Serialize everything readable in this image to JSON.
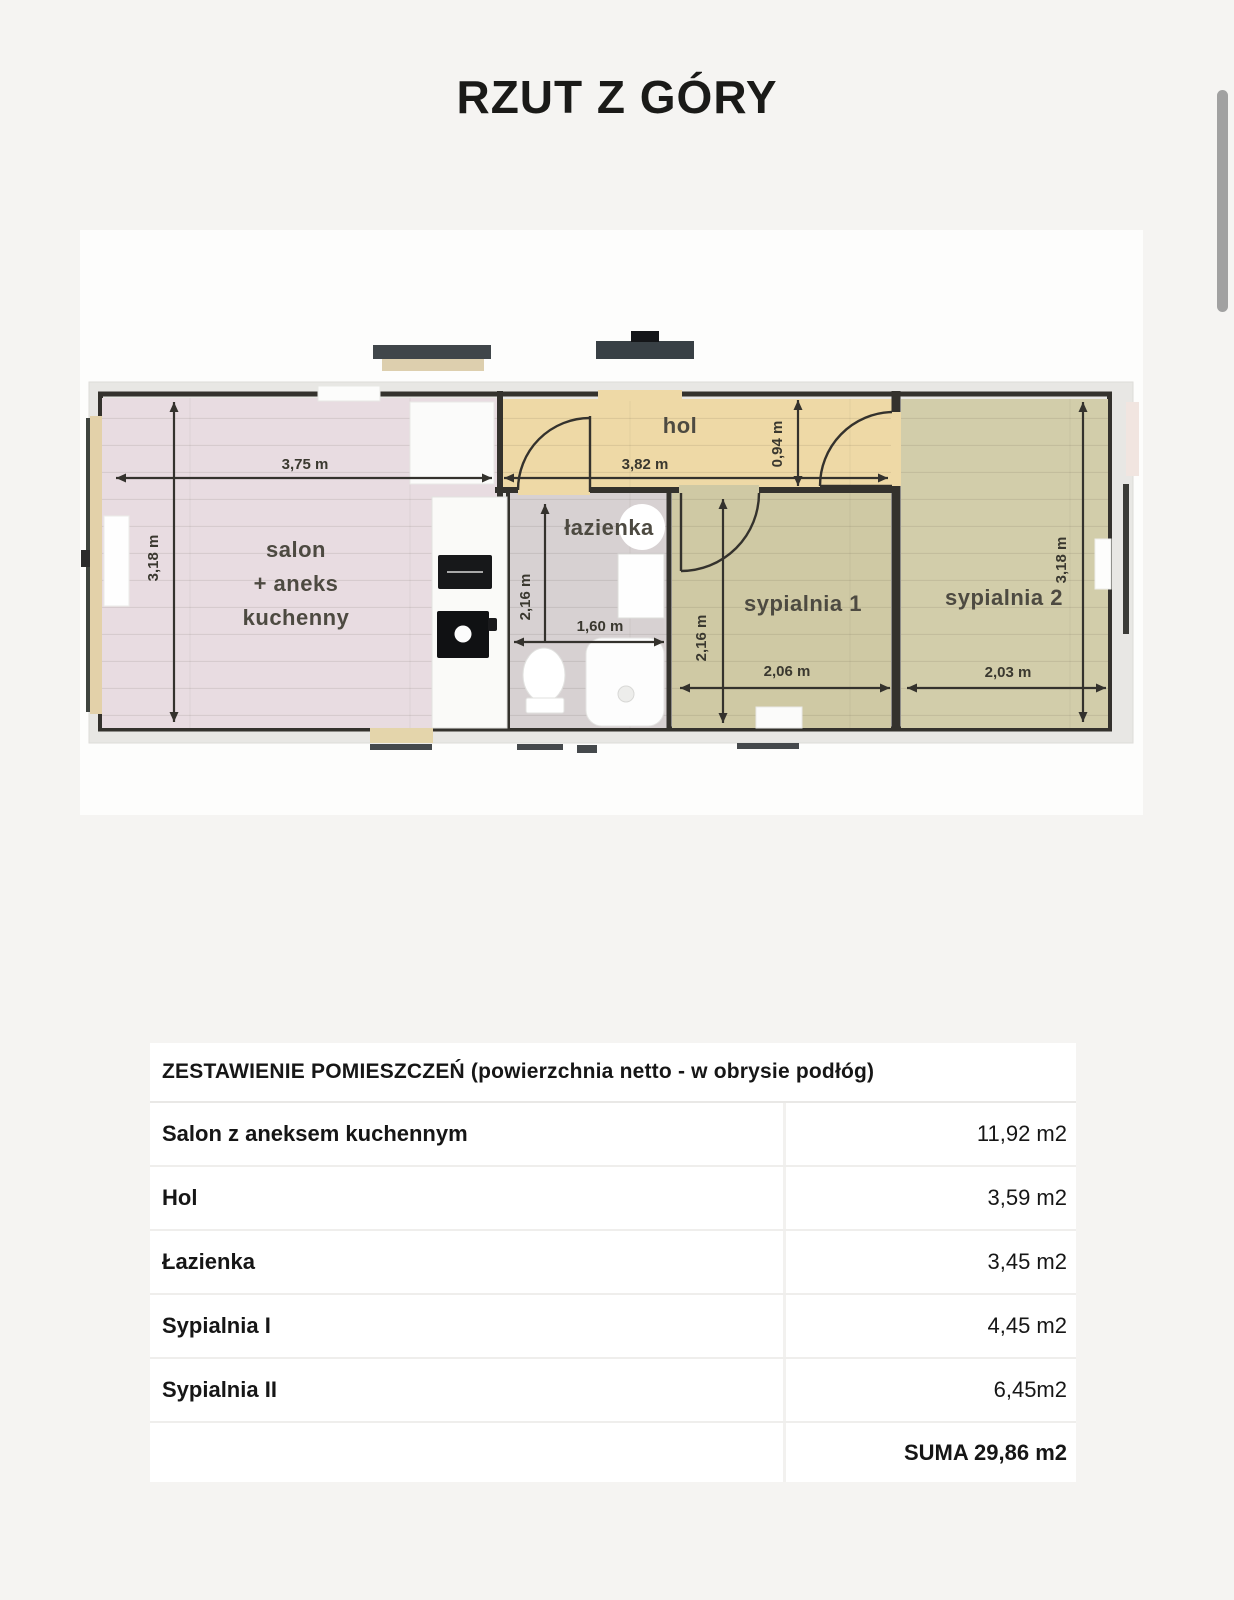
{
  "page": {
    "title": "RZUT Z GÓRY"
  },
  "floorplan": {
    "rooms": {
      "salon": {
        "label_lines": [
          "salon",
          "+ aneks",
          "kuchenny"
        ],
        "width": "3,75 m",
        "height": "3,18 m",
        "floor": "#e8dce1"
      },
      "hol": {
        "label": "hol",
        "width": "3,82 m",
        "height": "0,94 m",
        "floor": "#eed9a6"
      },
      "lazienka": {
        "label": "łazienka",
        "width": "1,60 m",
        "height": "2,16 m",
        "floor": "#d7d1d2"
      },
      "sypialnia1": {
        "label": "sypialnia 1",
        "width": "2,06 m",
        "height": "2,16 m",
        "floor": "#cfc9a4"
      },
      "sypialnia2": {
        "label": "sypialnia 2",
        "width": "2,03 m",
        "height": "3,18 m",
        "floor": "#d2cdaa"
      }
    },
    "wall_color": "#34322d"
  },
  "table": {
    "header": "ZESTAWIENIE POMIESZCZEŃ (powierzchnia netto - w obrysie podłóg)",
    "rows": [
      {
        "name": "Salon z aneksem kuchennym",
        "area": "11,92 m2"
      },
      {
        "name": "Hol",
        "area": "3,59 m2"
      },
      {
        "name": "Łazienka",
        "area": "3,45 m2"
      },
      {
        "name": "Sypialnia I",
        "area": "4,45 m2"
      },
      {
        "name": "Sypialnia II",
        "area": "6,45m2"
      }
    ],
    "total": "SUMA 29,86 m2"
  }
}
